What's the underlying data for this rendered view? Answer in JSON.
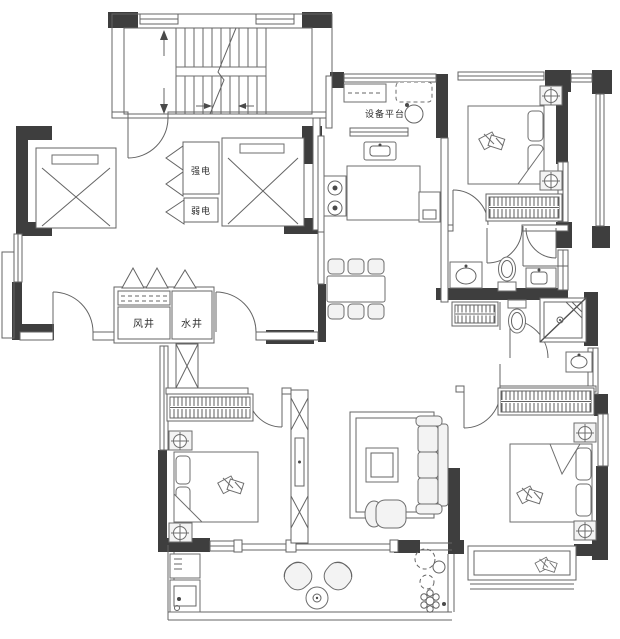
{
  "page": {
    "kind": "apartment floor plan drawing",
    "width": 620,
    "height": 639,
    "background": "#ffffff"
  },
  "colors": {
    "structural_wall": "#3e3e3e",
    "drawing_line": "#646464",
    "furniture_fill_light": "#f3f3f3",
    "label_text": "#2e2e2e"
  },
  "labels": {
    "equipment_platform": "设备平台",
    "strong_electric": "强电",
    "weak_electric": "弱电",
    "wind_shaft": "风井",
    "water_shaft": "水井"
  },
  "symbols": [
    "staircase",
    "elevator",
    "elevator",
    "strong-electric-closet",
    "weak-electric-closet",
    "wind-shaft",
    "water-shaft",
    "entry-door",
    "washing-machine",
    "kitchen-sink",
    "gas-stove",
    "kitchen-counter",
    "dining-table",
    "dining-chairs",
    "sofa",
    "coffee-table",
    "rug",
    "armchair",
    "tv-cabinet",
    "shoe-cabinet",
    "double-bed",
    "double-bed",
    "double-bed",
    "nightstand-lamp",
    "wardrobe",
    "toilet",
    "toilet",
    "wash-basin",
    "corner-shower",
    "bay-window",
    "balcony-chairs",
    "round-tea-table",
    "potted-plants",
    "laundry-sink"
  ]
}
